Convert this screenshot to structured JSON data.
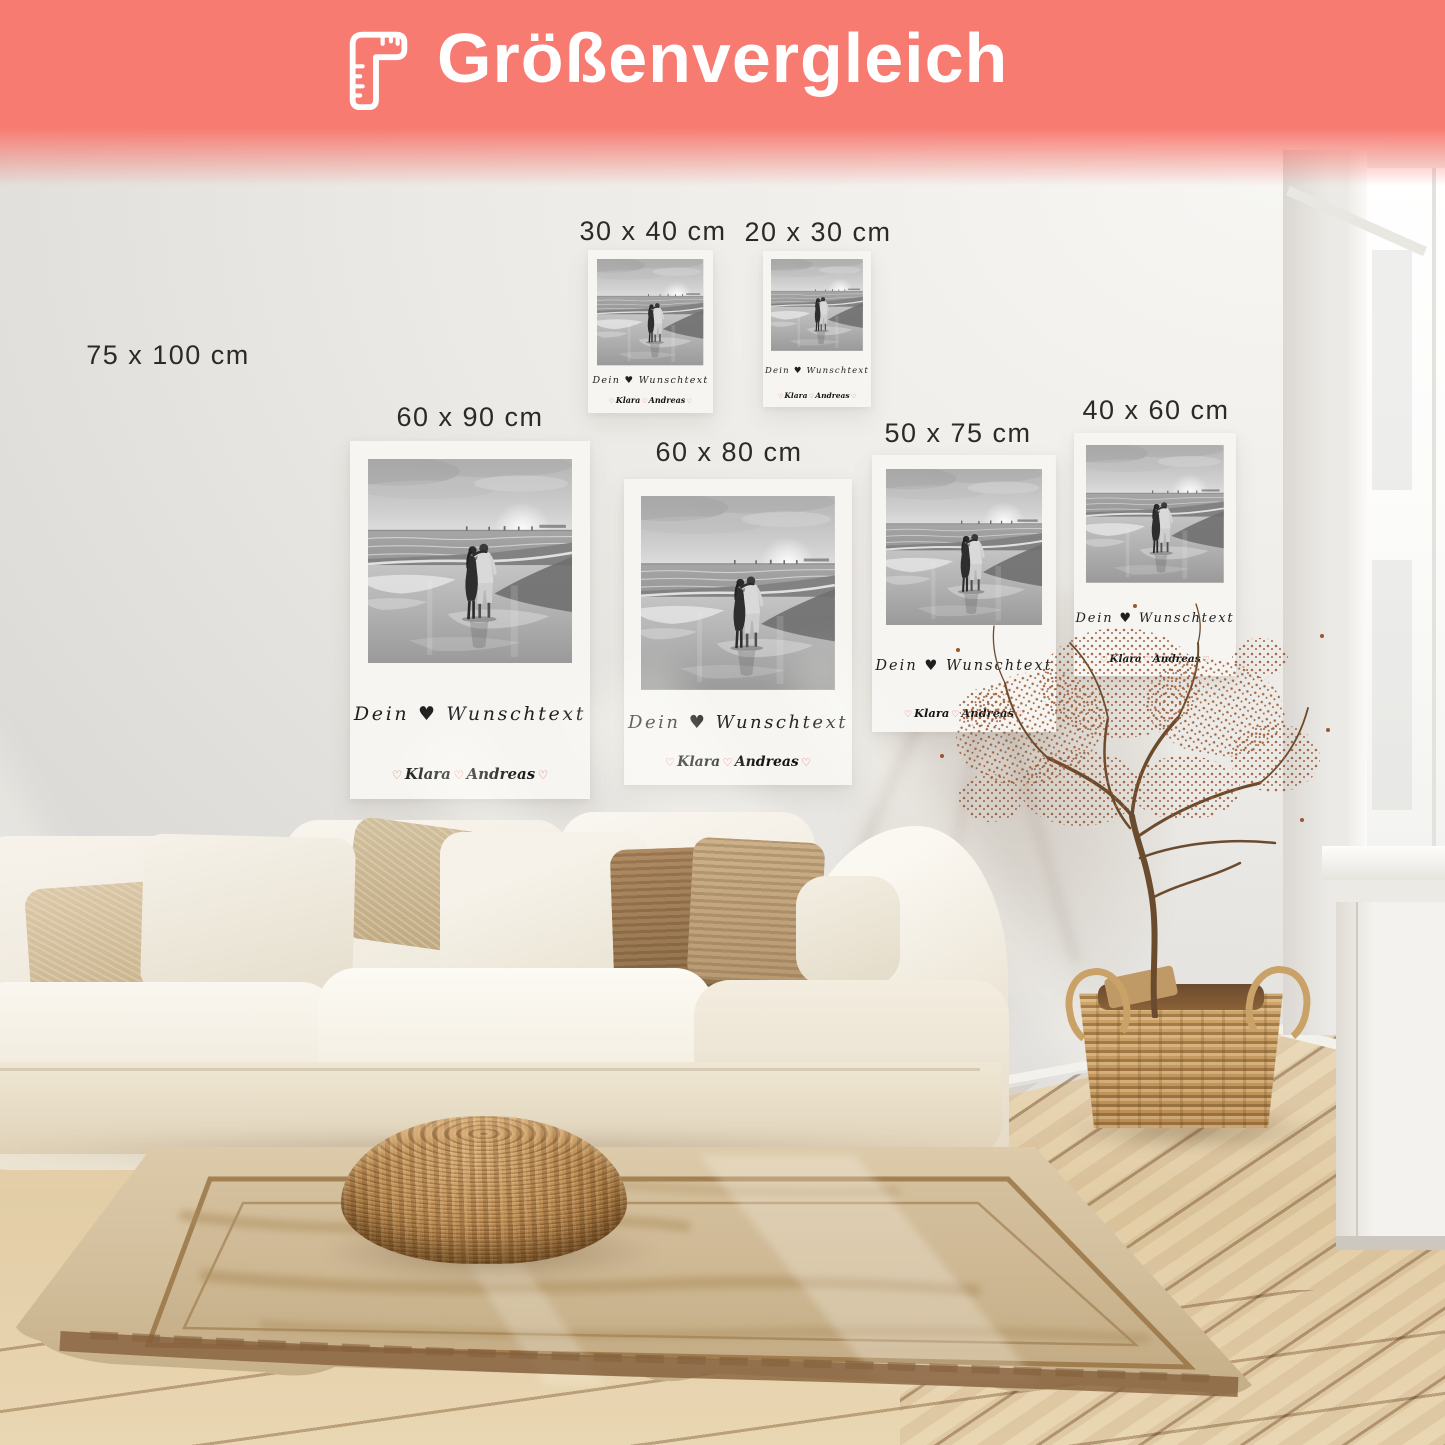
{
  "header": {
    "title": "Größenvergleich",
    "icon": "ruler-icon",
    "bg_color": "#F87B72",
    "text_color": "#FFFFFF"
  },
  "sizes": {
    "s75x100": "75 x 100 cm",
    "s30x40": "30 x 40 cm",
    "s20x30": "20 x 30 cm",
    "s60x90": "60 x 90 cm",
    "s60x80": "60 x 80 cm",
    "s50x75": "50 x 75 cm",
    "s40x60": "40 x 60 cm"
  },
  "poster_text": {
    "line1": "Dein ♥ Wunschtext",
    "heart_outline": "♡",
    "name_left": "Klara",
    "name_right": "Andreas",
    "accent_color": "#E26B63",
    "text_color": "#1F1F1F"
  },
  "label_color": "#2C2A27"
}
